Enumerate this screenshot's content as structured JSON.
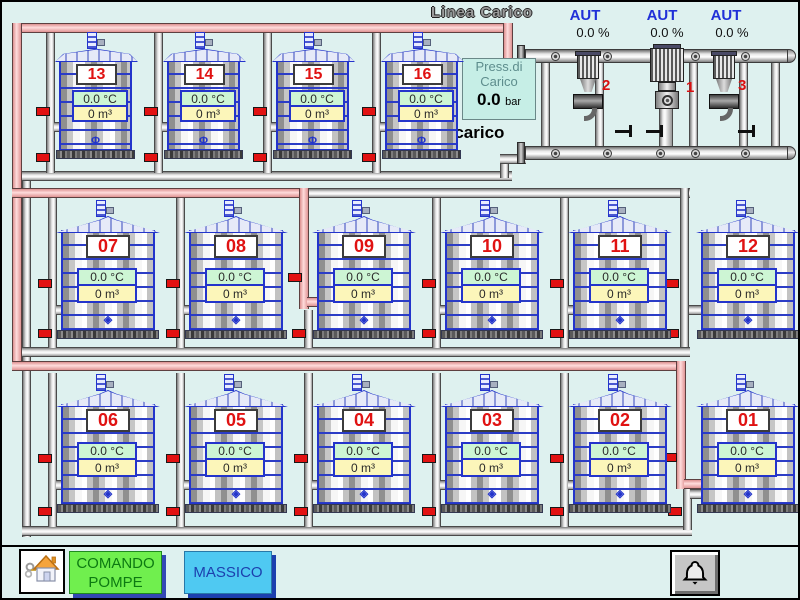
{
  "header": {
    "linea_carico_label": "Linea Carico"
  },
  "pump_station": {
    "pumps": [
      {
        "id": "2",
        "mode": "AUT",
        "value": "0.0 %"
      },
      {
        "id": "1",
        "mode": "AUT",
        "value": "0.0 %"
      },
      {
        "id": "3",
        "mode": "AUT",
        "value": "0.0 %"
      }
    ],
    "pressure_box": {
      "label_line1": "Press.di",
      "label_line2": "Carico",
      "value": "0.0",
      "unit": "bar"
    },
    "scarico_label": "Scarico"
  },
  "tanks": [
    {
      "id": "13",
      "temp": "0.0 °C",
      "volume": "0 m³"
    },
    {
      "id": "14",
      "temp": "0.0 °C",
      "volume": "0 m³"
    },
    {
      "id": "15",
      "temp": "0.0 °C",
      "volume": "0 m³"
    },
    {
      "id": "16",
      "temp": "0.0 °C",
      "volume": "0 m³"
    },
    {
      "id": "07",
      "temp": "0.0 °C",
      "volume": "0 m³"
    },
    {
      "id": "08",
      "temp": "0.0 °C",
      "volume": "0 m³"
    },
    {
      "id": "09",
      "temp": "0.0 °C",
      "volume": "0 m³"
    },
    {
      "id": "10",
      "temp": "0.0 °C",
      "volume": "0 m³"
    },
    {
      "id": "11",
      "temp": "0.0 °C",
      "volume": "0 m³"
    },
    {
      "id": "12",
      "temp": "0.0 °C",
      "volume": "0 m³"
    },
    {
      "id": "06",
      "temp": "0.0 °C",
      "volume": "0 m³"
    },
    {
      "id": "05",
      "temp": "0.0 °C",
      "volume": "0 m³"
    },
    {
      "id": "04",
      "temp": "0.0 °C",
      "volume": "0 m³"
    },
    {
      "id": "03",
      "temp": "0.0 °C",
      "volume": "0 m³"
    },
    {
      "id": "02",
      "temp": "0.0 °C",
      "volume": "0 m³"
    },
    {
      "id": "01",
      "temp": "0.0 °C",
      "volume": "0 m³"
    }
  ],
  "footer": {
    "comando_pompe": {
      "line1": "COMANDO",
      "line2": "POMPE"
    },
    "massico_label": "MASSICO",
    "home_icon": "home",
    "alarm_icon": "bell"
  },
  "colors": {
    "background": "#def1ef",
    "carico_line_pink": "#f2b2b2",
    "pipe_gray": "#c8c8c8",
    "tank_outline_blue": "#2334cb",
    "alarm_red": "#e21212",
    "temp_box_green": "#cdf5d4",
    "volume_box_yellow": "#fcf6ba",
    "comando_button_green": "#70ef4e",
    "massico_button_cyan": "#4fc9f2",
    "aut_blue": "#2030d8"
  }
}
